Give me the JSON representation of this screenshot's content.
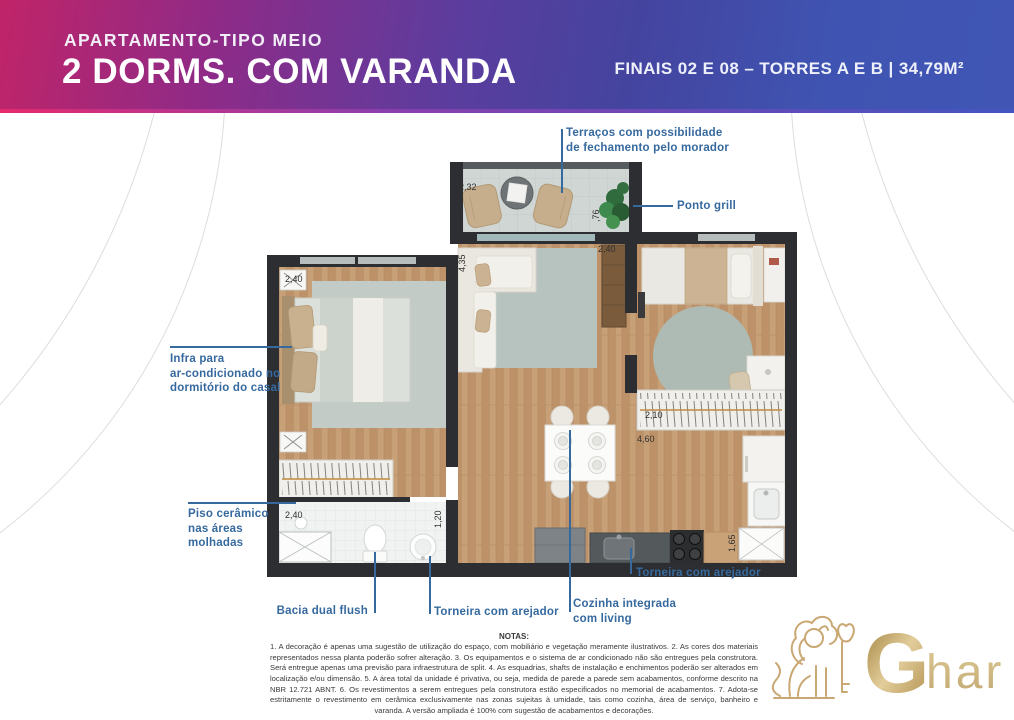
{
  "header": {
    "subtitle": "APARTAMENTO-TIPO MEIO",
    "title": "2 DORMS. COM VARANDA",
    "info": "FINAIS 02 E 08 – TORRES A E B | 34,79M²"
  },
  "plan": {
    "dims": {
      "terrace_w": "2,32",
      "terrace_d": ",76",
      "living_len": "4,35",
      "living_top": "2,40",
      "bed2_side": "2,60",
      "bed1_w": "2,40",
      "bed1_len": "3,00",
      "bath_w": "2,40",
      "bath_d": "1,20",
      "ward2_w": "2,10",
      "living_w": "4,60",
      "laundry": "1,65"
    },
    "callouts": {
      "terrace_l1": "Terraços com possibilidade",
      "terrace_l2": "de fechamento pelo morador",
      "grill": "Ponto grill",
      "ac_l1": "Infra para",
      "ac_l2": "ar-condicionado no",
      "ac_l3": "dormitório do casal",
      "ceramic_l1": "Piso cerâmico",
      "ceramic_l2": "nas áreas",
      "ceramic_l3": "molhadas",
      "toilet": "Bacia dual flush",
      "bath_faucet": "Torneira com arejador",
      "kitchen_l1": "Cozinha integrada",
      "kitchen_l2": "com living",
      "kitchen_faucet": "Torneira com arejador"
    }
  },
  "notes": {
    "heading": "NOTAS:",
    "body": "1. A decoração é apenas uma sugestão de utilização do espaço, com mobiliário e vegetação meramente ilustrativos. 2. As cores dos materiais representados nessa planta poderão sofrer alteração. 3. Os equipamentos e o sistema de ar condicionado não são entregues pela construtora. Será entregue apenas uma previsão para infraestrutura de split. 4. As esquadrias, shafts de instalação e enchimentos poderão ser alterados em localização e/ou dimensão. 5. A área total da unidade é privativa, ou seja, medida de parede a parede sem acabamentos, conforme descrito na NBR 12.721 ABNT. 6. Os revestimentos a serem entregues pela construtora estão especificados no memorial de acabamentos. 7. Adota-se estritamente o revestimento em cerâmica exclusivamente nas zonas sujeitas à umidade, tais como cozinha, área de serviço, banheiro e varanda. A versão ampliada é 100% com sugestão de acabamentos e decorações."
  },
  "logo": {
    "g": "G",
    "har": "har"
  },
  "colors": {
    "header_pink": "#c02468",
    "header_purple": "#5b3d9e",
    "header_blue": "#3f54b2",
    "callout_blue": "#36699e",
    "gold": "#c9a874",
    "wall": "#2c2e31"
  }
}
